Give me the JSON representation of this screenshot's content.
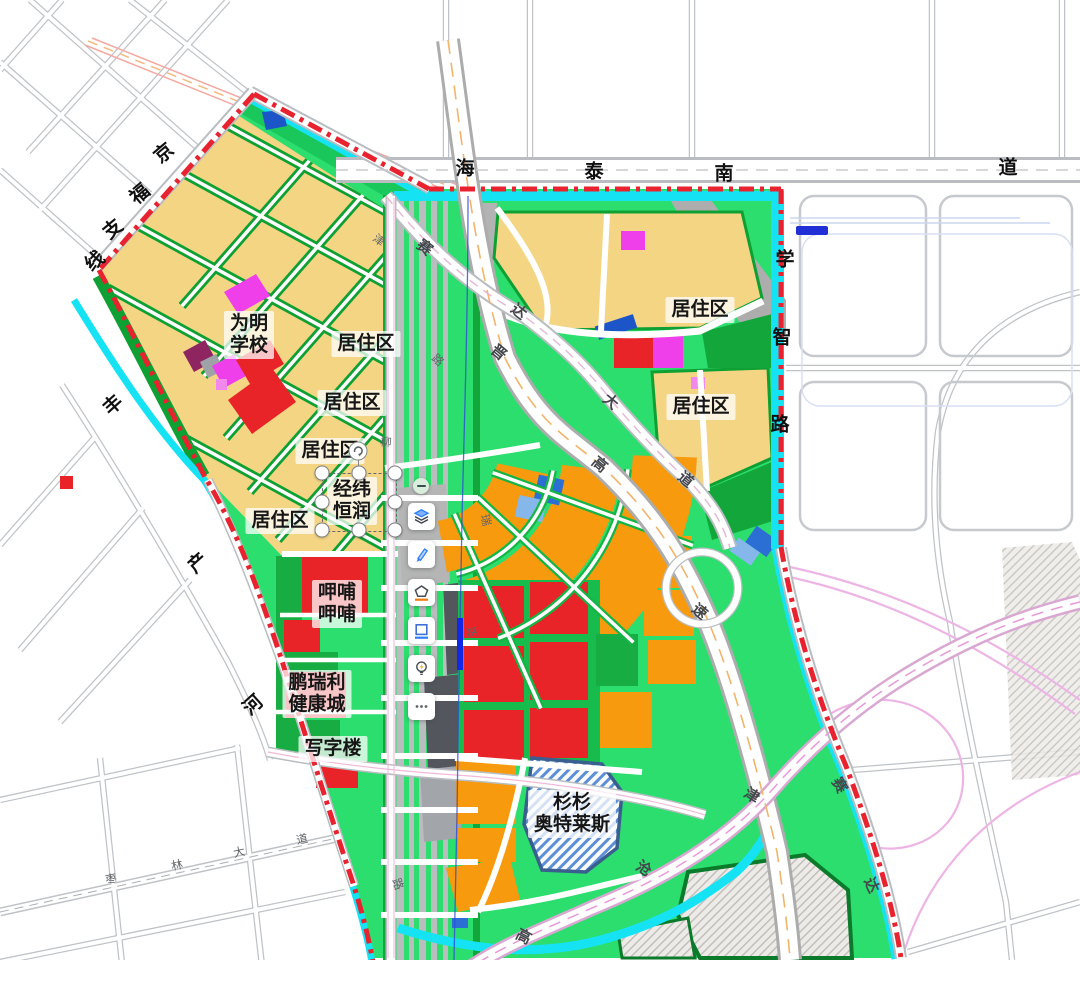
{
  "colors": {
    "boundary_red": "#e8222e",
    "park_green": "#2bde6e",
    "strip_green": "#0fa033",
    "parcel_yellow": "#f4d584",
    "parcel_orange": "#f79a0d",
    "parcel_red": "#e92428",
    "parcel_magenta": "#ee3fea",
    "parcel_pink": "#f287ee",
    "parcel_purple": "#8e2560",
    "water_cyan": "#15e3f4",
    "parcel_blue": "#2b6fd4",
    "parcel_blue_light": "#85b7ea",
    "accent_blue": "#2d7ff9",
    "accent_orange": "#f07c10"
  },
  "road_labels": [
    {
      "text": "京"
    },
    {
      "text": "福"
    },
    {
      "text": "支"
    },
    {
      "text": "线"
    },
    {
      "text": "海"
    },
    {
      "text": "泰"
    },
    {
      "text": "南"
    },
    {
      "text": "道"
    },
    {
      "text": "学"
    },
    {
      "text": "智"
    },
    {
      "text": "路"
    },
    {
      "text": "丰"
    },
    {
      "text": "产"
    },
    {
      "text": "河"
    },
    {
      "text": "赛"
    },
    {
      "text": "达"
    },
    {
      "text": "大"
    },
    {
      "text": "道"
    },
    {
      "text": "晋"
    },
    {
      "text": "高"
    },
    {
      "text": "速"
    },
    {
      "text": "津"
    },
    {
      "text": "沧"
    },
    {
      "text": "高"
    },
    {
      "text": "赛"
    },
    {
      "text": "达"
    },
    {
      "text": "柳"
    },
    {
      "text": "枣"
    },
    {
      "text": "林"
    },
    {
      "text": "大"
    },
    {
      "text": "道"
    },
    {
      "text": "路"
    },
    {
      "text": "瑞"
    },
    {
      "text": "达"
    },
    {
      "text": "津"
    },
    {
      "text": "路"
    }
  ],
  "area_labels": [
    {
      "lines": [
        "为明",
        "学校"
      ]
    },
    {
      "lines": [
        "居住区"
      ]
    },
    {
      "lines": [
        "居住区"
      ]
    },
    {
      "lines": [
        "居住区"
      ]
    },
    {
      "lines": [
        "居住区"
      ]
    },
    {
      "lines": [
        "经纬",
        "恒润"
      ]
    },
    {
      "lines": [
        "居住区"
      ]
    },
    {
      "lines": [
        "居住区"
      ]
    },
    {
      "lines": [
        "呷哺",
        "呷哺"
      ]
    },
    {
      "lines": [
        "鹏瑞利",
        "健康城"
      ]
    },
    {
      "lines": [
        "写字楼"
      ]
    },
    {
      "lines": [
        "杉杉",
        "奥特莱斯"
      ]
    }
  ],
  "toolbar": {
    "buttons": [
      {
        "name": "collapse",
        "icon": "minus-icon"
      },
      {
        "name": "layers",
        "icon": "layers-icon"
      },
      {
        "name": "draw",
        "icon": "brush-icon"
      },
      {
        "name": "shape",
        "icon": "polygon-icon"
      },
      {
        "name": "rectangle",
        "icon": "rectangle-icon"
      },
      {
        "name": "tips",
        "icon": "lightbulb-icon"
      },
      {
        "name": "more",
        "icon": "ellipsis-icon"
      }
    ]
  }
}
